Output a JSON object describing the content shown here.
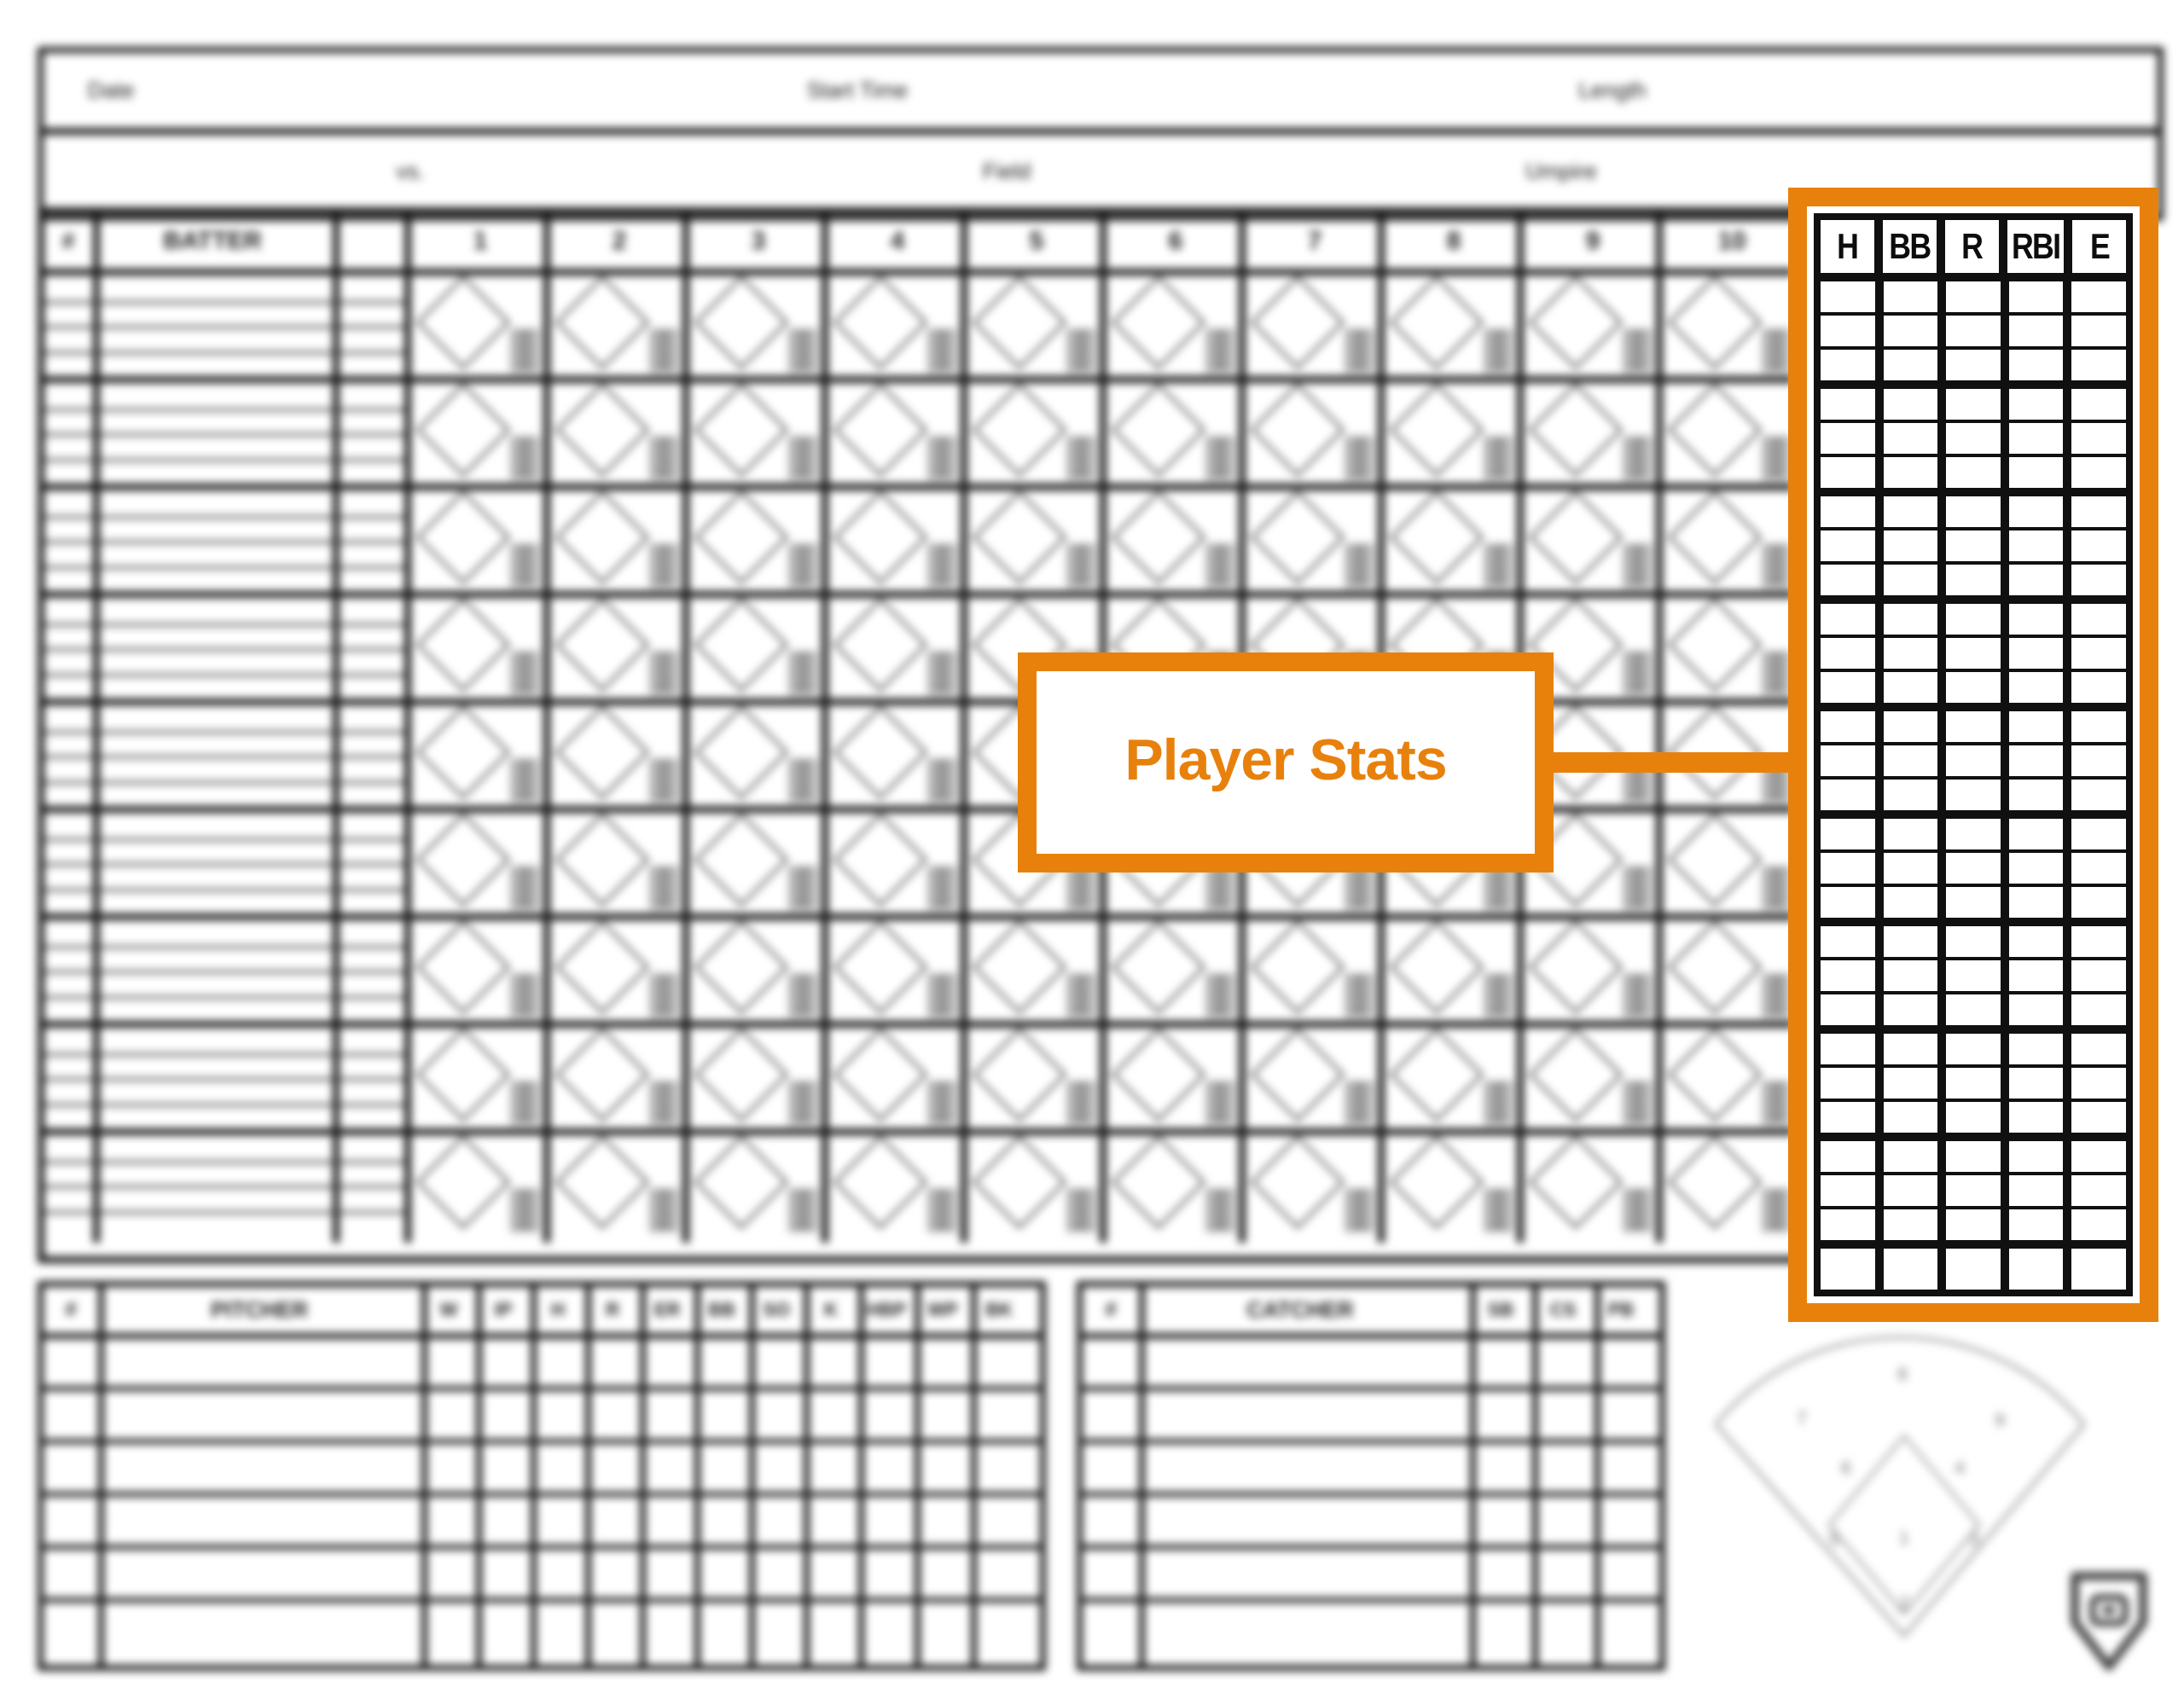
{
  "accent_color": "#E8810C",
  "ink_color": "#181818",
  "top_header": {
    "date_label": "Date",
    "start_time_label": "Start Time",
    "length_label": "Length",
    "vs_label": "vs.",
    "field_label": "Field",
    "umpire_label": "Umpire"
  },
  "batting_grid": {
    "number_col_label": "#",
    "batter_col_label": "BATTER",
    "inning_labels": [
      "1",
      "2",
      "3",
      "4",
      "5",
      "6",
      "7",
      "8",
      "9",
      "10"
    ],
    "batter_rows": 9,
    "sub_rows_per_batter": 4,
    "cell_corner_labels": [
      "1B",
      "2B",
      "3B",
      "HR"
    ]
  },
  "player_stats": {
    "callout_label": "Player Stats",
    "columns": [
      "H",
      "BB",
      "R",
      "RBI",
      "E"
    ],
    "player_groups": 9,
    "rows_per_group": 3,
    "has_totals_row": true
  },
  "pitcher_table": {
    "number_col_label": "#",
    "name_col_label": "PITCHER",
    "stat_columns": [
      "W",
      "IP",
      "H",
      "R",
      "ER",
      "BB",
      "SO",
      "K"
    ],
    "wide_stat_columns": [
      "HBP",
      "WP",
      "BK"
    ],
    "data_rows": 6
  },
  "catcher_table": {
    "number_col_label": "#",
    "name_col_label": "CATCHER",
    "stat_columns": [
      "SB",
      "CS",
      "PB"
    ],
    "data_rows": 6
  },
  "field_diagram": {
    "position_numbers": [
      "1",
      "2",
      "3",
      "4",
      "5",
      "6",
      "7",
      "8",
      "9"
    ]
  },
  "logo_icon": "home-plate-logo"
}
